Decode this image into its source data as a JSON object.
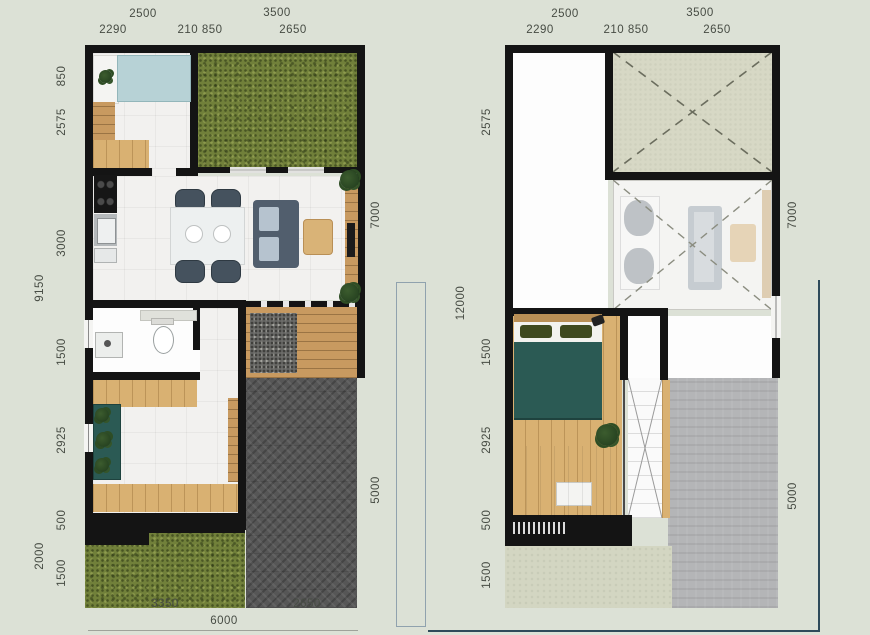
{
  "title": "two-storey house floor plans (ground floor and upper floor) with dimensions in millimetres",
  "left_plan": {
    "name": "ground floor plan",
    "top_dims_row1": [
      "2500",
      "3500"
    ],
    "top_dims_row2": [
      "2290",
      "210 850",
      "2650"
    ],
    "left_dims_outer": [
      "9150",
      "2000"
    ],
    "left_dims_inner": [
      "850",
      "2575",
      "3000",
      "1500",
      "2925",
      "500",
      "1500"
    ],
    "right_dims": [
      "7000",
      "5000"
    ],
    "bottom_dims": [
      "3350",
      "2650"
    ],
    "bottom_total": "6000"
  },
  "right_plan": {
    "name": "upper floor plan",
    "top_dims_row1": [
      "2500",
      "3500"
    ],
    "top_dims_row2": [
      "2290",
      "210 850",
      "2650"
    ],
    "left_dims_outer": [
      "12000"
    ],
    "left_dims_inner": [
      "2575",
      "1500",
      "2925",
      "500",
      "1500"
    ],
    "right_dims": [
      "7000",
      "5000"
    ]
  },
  "colors": {
    "background": "#dce1d6",
    "wall": "#141414",
    "grass": "#71803a",
    "carport_paving": "#565656",
    "roof_slab": "#b4b5b7",
    "wood_deck": "#d9b172",
    "teal_bed": "#2b5a54",
    "blue_bed": "#b7d2d6",
    "void_hatch": "#d7d8c5",
    "balcony_slab": "#d3d6c2",
    "dimension_text": "#474c44",
    "boundary_line": "#2e4a5a"
  }
}
